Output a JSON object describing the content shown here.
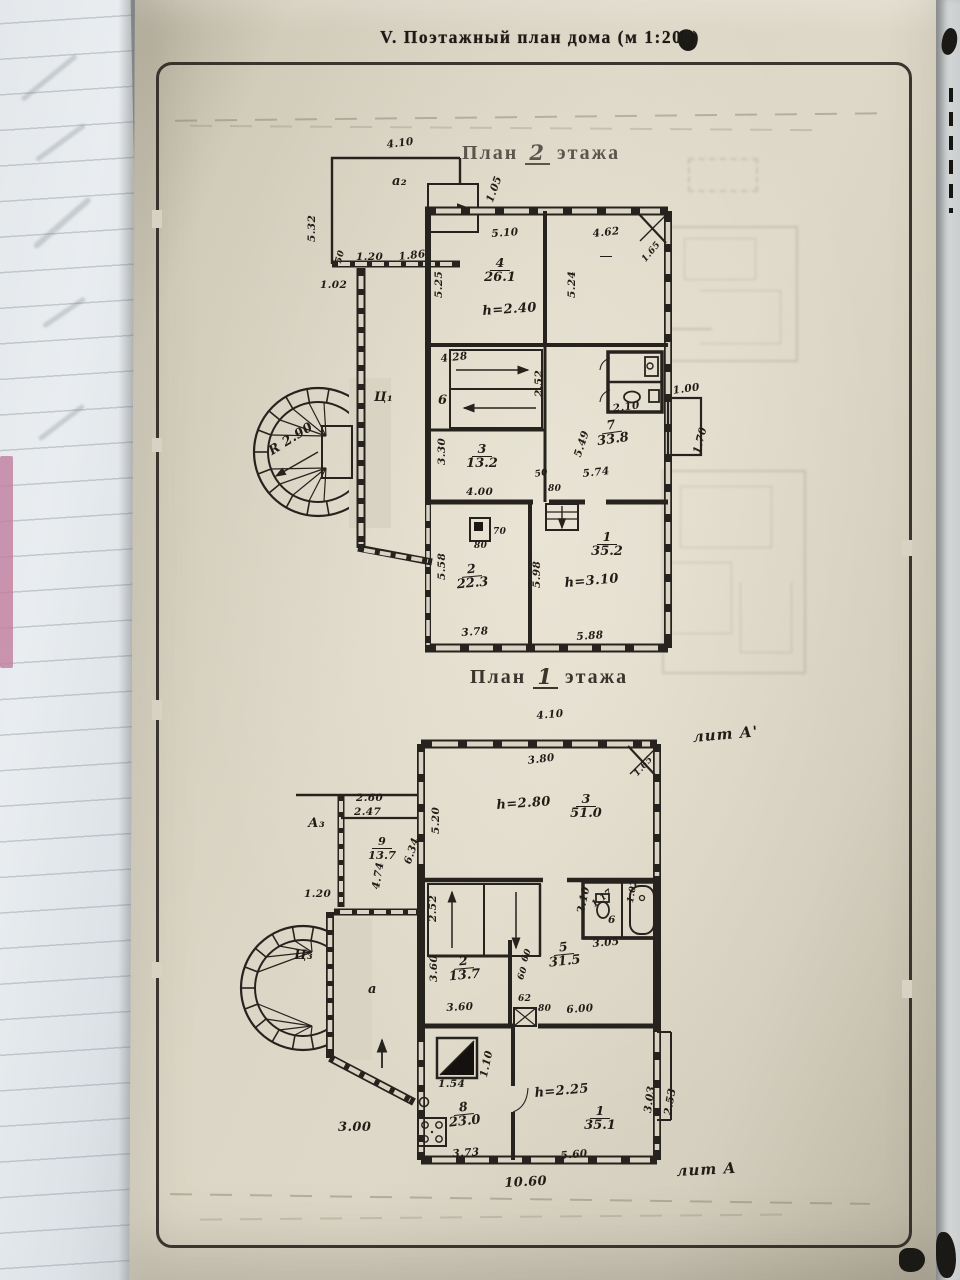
{
  "page": {
    "title": "V. Поэтажный план дома (м 1:200)"
  },
  "plan2": {
    "t1": "План",
    "t2": "2",
    "t3": "этажа",
    "d": {
      "w410": "4.10",
      "a2": "а₂",
      "s105": "1.05",
      "h532": "5.32",
      "n50": "50",
      "n120": "1.20",
      "n186": "1.86",
      "n102": "1.02",
      "r4n": "4",
      "r4a": "26.1",
      "r4h": "h=2.40",
      "w510": "5.10",
      "w462": "4.62",
      "c165": "1.65",
      "v525": "5.25",
      "v524": "5.24",
      "s428": "4.28",
      "r6": "6",
      "v252": "2.52",
      "hall": "Ц₁",
      "r3n": "3",
      "r3a": "13.2",
      "w400": "4.00",
      "v330": "3.30",
      "n80": "80",
      "r7n": "7",
      "r7a": "33.8",
      "v549": "5.49",
      "w574": "5.74",
      "w210": "2.10",
      "w100": "1.00",
      "v170": "1.70",
      "r2n": "2",
      "r2a": "22.3",
      "n70": "70",
      "v558": "5.58",
      "v598": "5.98",
      "w378": "3.78",
      "w588": "5.88",
      "r1n": "1",
      "r1a": "35.2",
      "r1h": "h=3.10",
      "radius": "R 2.90"
    }
  },
  "plan1": {
    "t1": "План",
    "t2": "1",
    "t3": "этажа",
    "litA1": "лит А'",
    "litA": "лит А",
    "d": {
      "w410": "4.10",
      "w380": "3.80",
      "c165": "1.65",
      "v520": "5.20",
      "r3n": "3",
      "r3a": "51.0",
      "r3h": "h=2.80",
      "a3": "А₃",
      "w260": "2.60",
      "w247": "2.47",
      "v634": "6.34",
      "v474": "4.74",
      "r9n": "9",
      "r9a": "13.7",
      "n120": "1.20",
      "v252": "2.52",
      "v210": "2.10",
      "n117": "1.17",
      "n102": "1.02",
      "r6": "6",
      "w305": "3.05",
      "r5n": "5",
      "r5a": "31.5",
      "n60": "60",
      "r2n": "2",
      "r2a": "13.7",
      "v360": "3.60",
      "w360": "3.60",
      "n62": "62",
      "n80": "80",
      "w600": "6.00",
      "tower": "Ц₃",
      "ver": "а",
      "n154": "1.54",
      "v110": "1.10",
      "r8n": "8",
      "r8a": "23.0",
      "w373": "3.73",
      "r1n": "1",
      "r1a": "35.1",
      "r1h": "h=2.25",
      "w560": "5.60",
      "v303": "3.03",
      "v253": "2.53",
      "total": "10.60",
      "w300": "3.00"
    }
  }
}
